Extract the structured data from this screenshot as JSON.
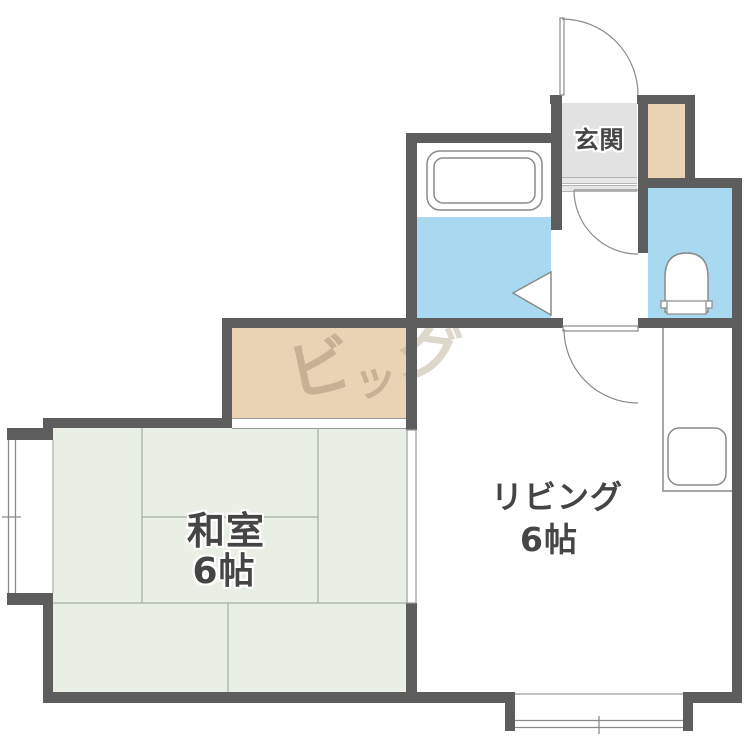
{
  "rooms": {
    "genkan": {
      "label": "玄関"
    },
    "washitsu": {
      "label": "和室",
      "size": "6帖"
    },
    "living": {
      "label": "リビング",
      "size": "6帖"
    }
  },
  "watermark": {
    "text": "ビッグ",
    "chars": [
      "ビ",
      "ッ",
      "グ"
    ]
  },
  "colors": {
    "wall": "#5d5d5d",
    "tatami_green": "#e9efe5",
    "water_blue": "#a9d9f1",
    "closet_beige": "#e9d3b4",
    "genkan_gray": "#e2e2e2",
    "label_text": "#454545",
    "watermark_brown": "#998368"
  },
  "fixtures": {
    "bathtub": "bathtub",
    "toilet": "toilet",
    "kitchen_sink": "kitchen-sink",
    "entrance_door": "entrance-swing-door",
    "hall_door": "hall-swing-door",
    "living_door": "living-swing-door",
    "bath_door": "bath-folding-door",
    "window_left": "window-left",
    "window_bottom": "window-bottom",
    "sliding_door": "washitsu-sliding-door"
  }
}
